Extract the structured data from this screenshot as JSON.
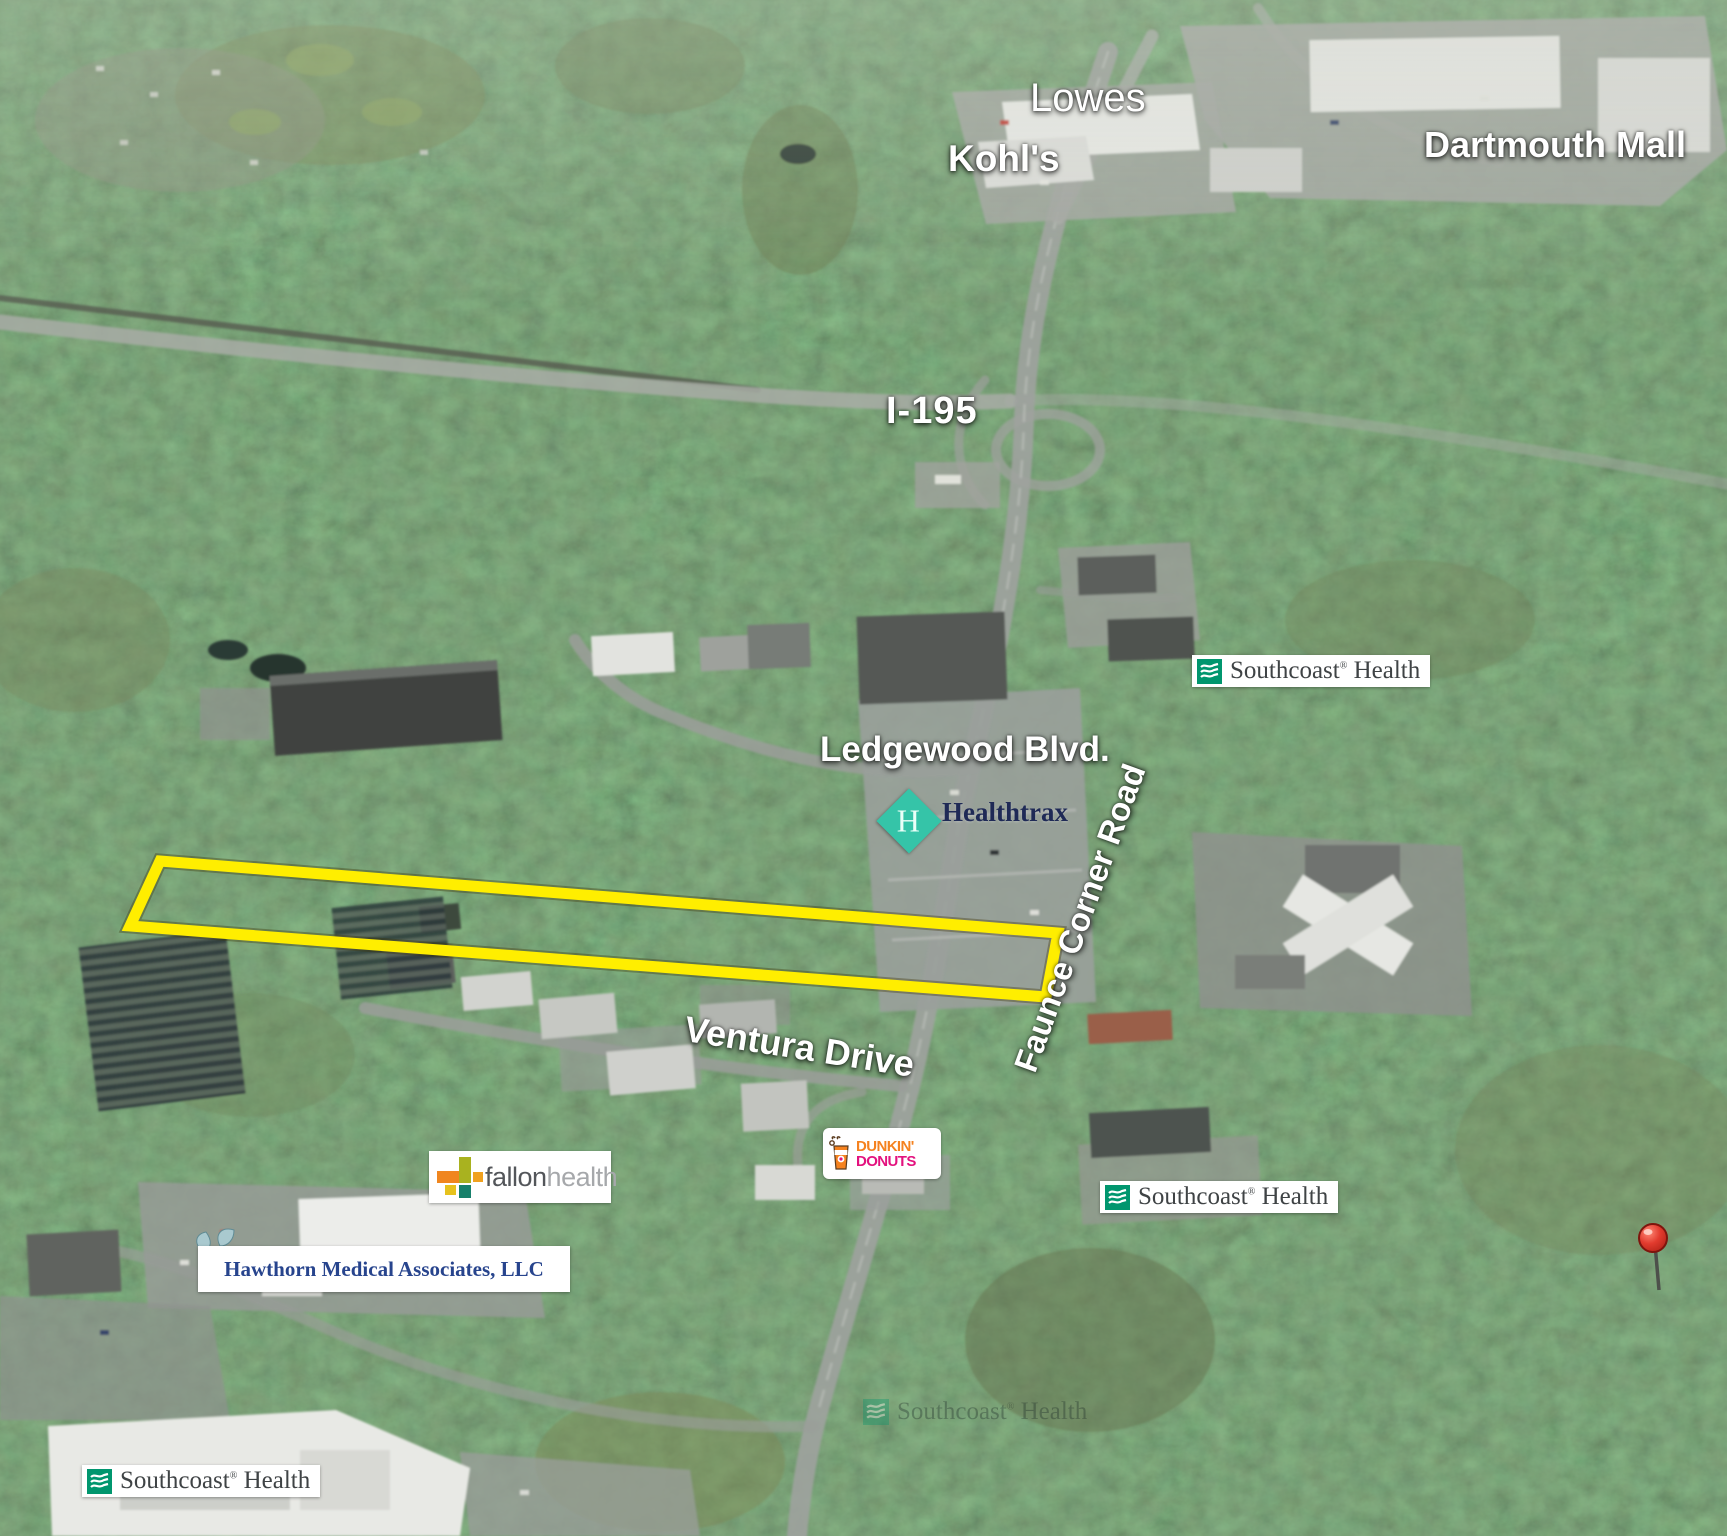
{
  "map": {
    "type": "aerial-oblique-photo",
    "area_labels": {
      "lowes": "Lowes",
      "kohls": "Kohl's",
      "dartmouth_mall": "Dartmouth Mall",
      "i195": "I-195",
      "ledgewood_blvd": "Ledgewood Blvd.",
      "faunce_corner_road": "Faunce Corner Road",
      "ventura_drive": "Ventura Drive"
    },
    "southcoast": {
      "word1": "Southcoast",
      "reg": "®",
      "word2": "Health"
    },
    "healthtrax": {
      "monogram": "H",
      "name": "Healthtrax"
    },
    "dunkin": {
      "line1": "DUNKIN'",
      "line2": "DONUTS"
    },
    "fallon": {
      "word1": "fallon",
      "word2": "health"
    },
    "hawthorn": {
      "name": "Hawthorn Medical Associates, LLC"
    },
    "site_outline": {
      "color": "#FFEE00",
      "shape": "elongated wooded parcel highlighted along Ventura Drive",
      "corners_px": [
        [
          160,
          861
        ],
        [
          1058,
          933
        ],
        [
          1046,
          997
        ],
        [
          130,
          926
        ]
      ]
    },
    "marker": {
      "type": "red-pushpin"
    },
    "colors": {
      "southcoast_green": "#00966E",
      "southcoast_text": "#3F4345",
      "healthtrax_teal": "#35C4A8",
      "healthtrax_text": "#1F2A56",
      "dunkin_orange": "#F5821F",
      "dunkin_pink": "#E3117E",
      "fallon_dark": "#53565A",
      "fallon_gray": "#A6A8AB",
      "hawthorn_blue": "#27448D",
      "label_white": "#FFFFFF",
      "pin_red": "#DF3A2B"
    }
  }
}
